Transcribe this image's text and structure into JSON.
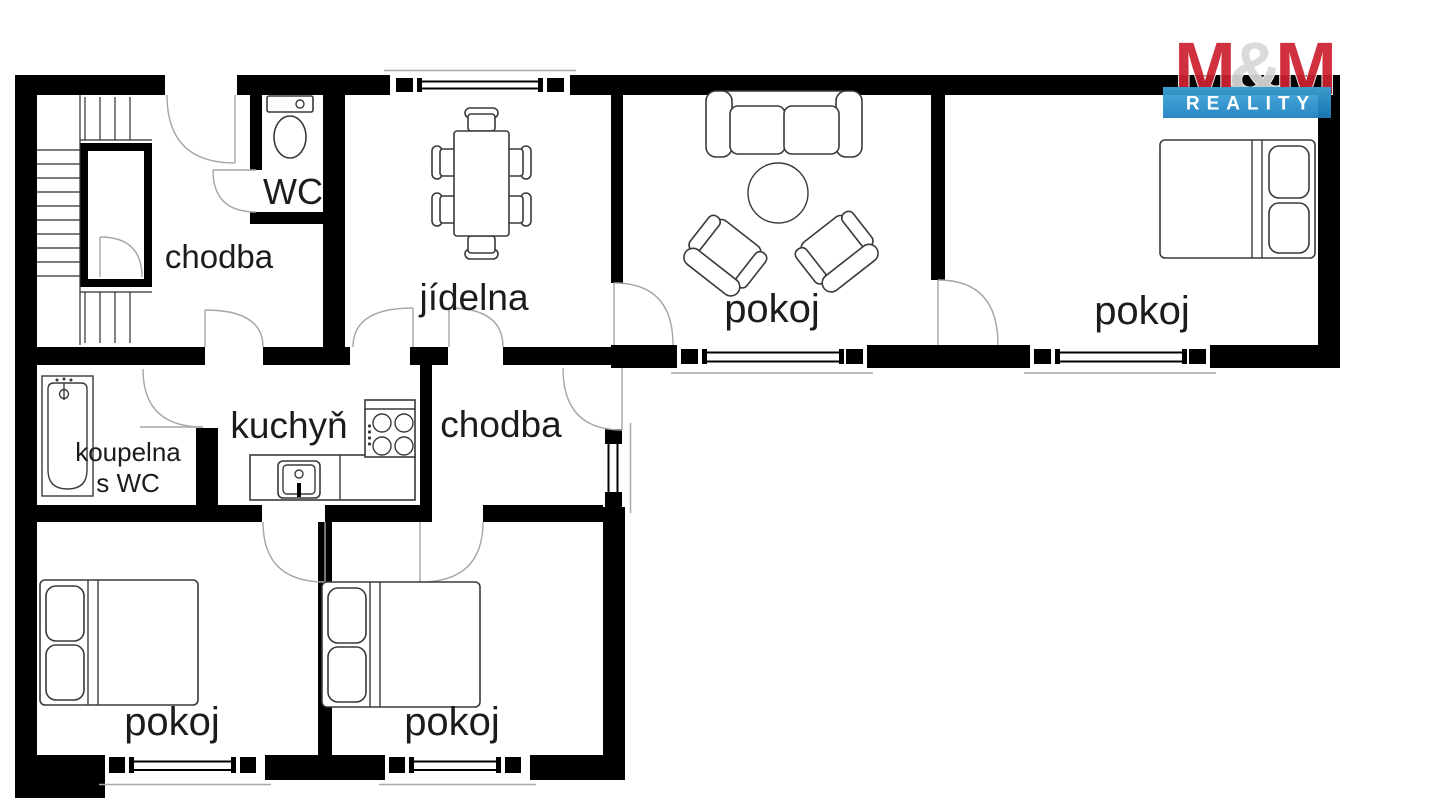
{
  "brand": {
    "m1": "M",
    "amp": "&",
    "m2": "M",
    "reality": "REALITY"
  },
  "rooms": {
    "hall_top": {
      "label": "chodba"
    },
    "wc": {
      "label": "WC"
    },
    "dining": {
      "label": "jídelna"
    },
    "living": {
      "label": "pokoj"
    },
    "bedroom_right": {
      "label": "pokoj"
    },
    "kitchen": {
      "label": "kuchyň"
    },
    "hall_lower": {
      "label": "chodba"
    },
    "bathroom": {
      "line1": "koupelna",
      "line2": "s WC"
    },
    "bedroom_bottom_left": {
      "label": "pokoj"
    },
    "bedroom_bottom_mid": {
      "label": "pokoj"
    }
  },
  "colors": {
    "wall": "#000000",
    "door": "#a6a6a6",
    "furniture": "#3a3a3a",
    "text": "#1c1c1c",
    "red": "#ce2130",
    "blue_light": "#3fa7db",
    "blue_dark": "#1b7fc0",
    "background": "#ffffff"
  }
}
